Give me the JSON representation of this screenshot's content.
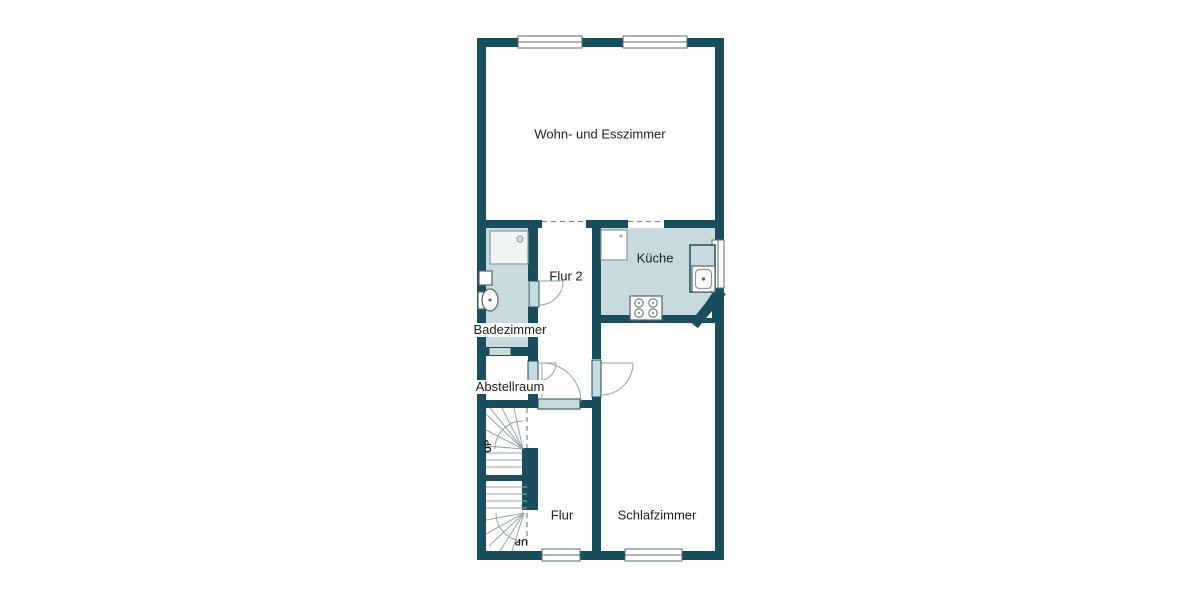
{
  "colors": {
    "wall": "#1a4e5d",
    "floor": "#c9dade",
    "door": "#c9dade",
    "line": "#97a5aa",
    "text": "#1f1f1f",
    "background": "#ffffff"
  },
  "rooms": {
    "living": {
      "label": "Wohn- und Esszimmer"
    },
    "hall2": {
      "label": "Flur 2"
    },
    "kitchen": {
      "label": "Küche"
    },
    "bathroom": {
      "label": "Badezimmer"
    },
    "storage": {
      "label": "Abstellraum"
    },
    "hall": {
      "label": "Flur"
    },
    "bedroom": {
      "label": "Schlafzimmer"
    }
  },
  "stairs": {
    "upper_label": "UP",
    "lower_label": "UP"
  },
  "fixtures": [
    "shower",
    "washbasin",
    "toilet",
    "kitchen-counter",
    "sink",
    "stove",
    "refrigerator"
  ]
}
